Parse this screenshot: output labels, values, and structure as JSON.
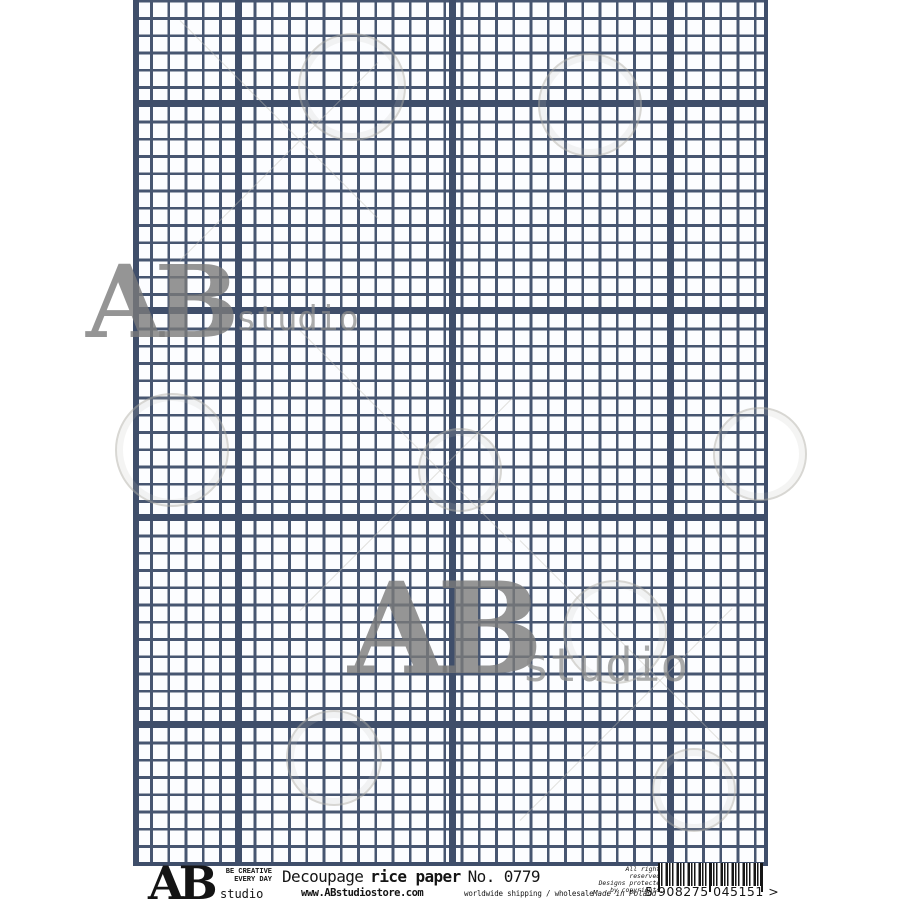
{
  "product": {
    "brand": "AB",
    "brand_sub": "studio",
    "tagline_line1": "BE CREATIVE",
    "tagline_line2": "EVERY DAY",
    "title_prefix": "Decoupage",
    "title_emphasis": "rice paper",
    "title_number": "No. 0779",
    "website": "www.ABstudiostore.com",
    "shipping": "worldwide shipping / wholesale",
    "rights_line1": "All rights reserved.",
    "rights_line2": "Designs protected",
    "rights_line3": "by copyrights.",
    "made_in": "Made in Poland",
    "barcode_text": "5 908275 045151 >"
  },
  "watermarks": {
    "top_left": {
      "ab": "AB",
      "studio": "studio"
    },
    "center": {
      "ab": "AB",
      "studio": "studio"
    }
  },
  "colors": {
    "grid-line": "#475671",
    "grid-major": "#3f4e6a",
    "paper": "#fcfdff",
    "watermark-gray": "#8a8a8a"
  }
}
